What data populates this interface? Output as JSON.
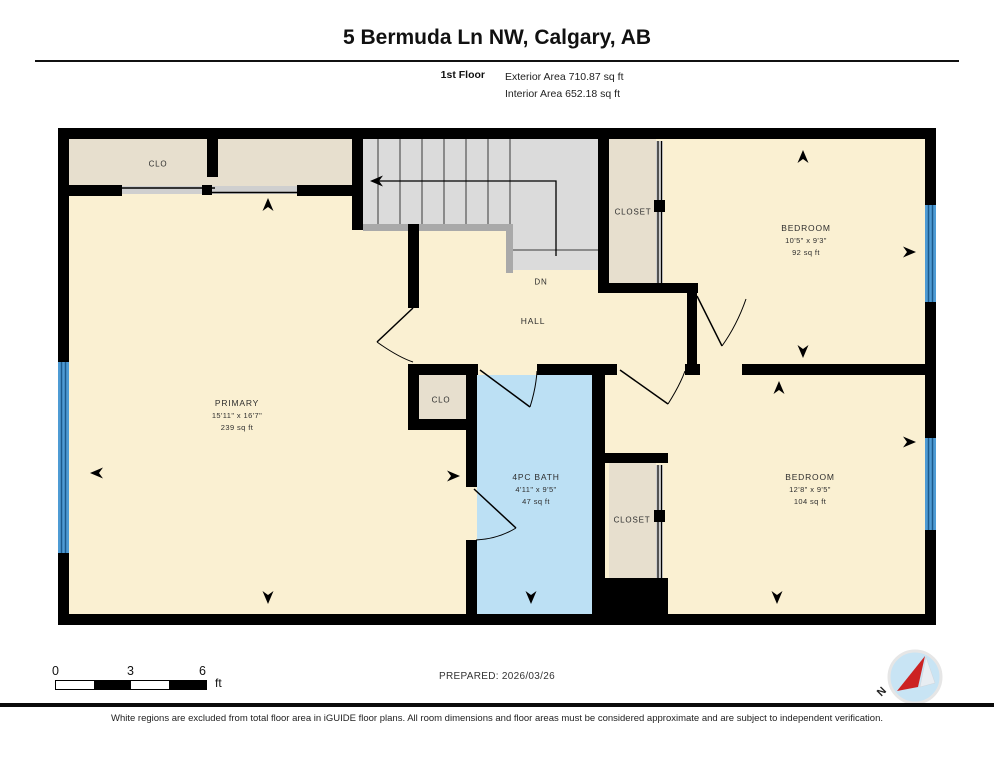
{
  "header": {
    "title": "5 Bermuda Ln NW, Calgary, AB",
    "floor_label": "1st Floor",
    "exterior_area": "Exterior Area 710.87 sq ft",
    "interior_area": "Interior Area 652.18 sq ft"
  },
  "rooms": {
    "primary": {
      "name": "PRIMARY",
      "dims": "15'11\" x 16'7\"",
      "area": "239 sq ft"
    },
    "bedroom_top": {
      "name": "BEDROOM",
      "dims": "10'5\" x 9'3\"",
      "area": "92 sq ft"
    },
    "bedroom_bottom": {
      "name": "BEDROOM",
      "dims": "12'8\" x 9'5\"",
      "area": "104 sq ft"
    },
    "bath": {
      "name": "4PC BATH",
      "dims": "4'11\" x 9'5\"",
      "area": "47 sq ft"
    },
    "hall": {
      "name": "HALL"
    },
    "stairs": {
      "label": "DN"
    },
    "closet_top_left": {
      "name": "CLO"
    },
    "closet_mid": {
      "name": "CLO"
    },
    "closet_top_right": {
      "name": "CLOSET"
    },
    "closet_bottom": {
      "name": "CLOSET"
    }
  },
  "scale_bar": {
    "ticks": [
      "0",
      "3",
      "6"
    ],
    "unit": "ft"
  },
  "footer": {
    "prepared": "PREPARED: 2026/03/26",
    "disclaimer": "White regions are excluded from total floor area in iGUIDE floor plans. All room dimensions and floor areas must be considered approximate and are subject to independent verification.",
    "compass_label": "N"
  },
  "colors": {
    "room_fill": "#FAF0D2",
    "closet_fill": "#E7DFCE",
    "stairs_fill": "#DBDBDB",
    "railing": "#A9A9A9",
    "bath_fill": "#BCE0F4",
    "window_blue": "#4E9BD4",
    "window_line": "#1C5A8C",
    "wall": "#000000",
    "compass_blue": "#C8E4F4",
    "compass_red": "#CC2222"
  }
}
